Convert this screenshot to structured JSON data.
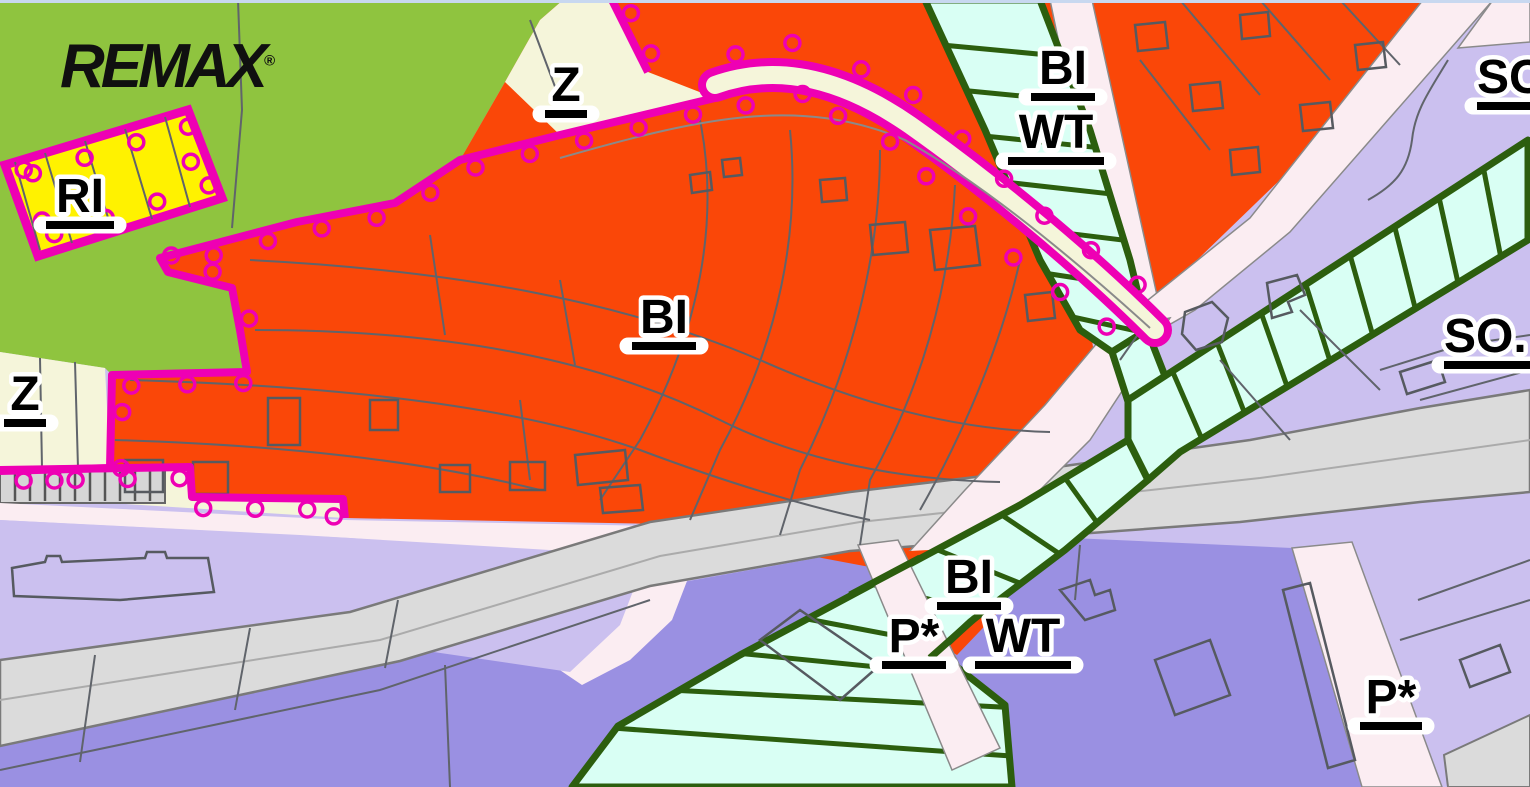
{
  "logo": {
    "text": "REMAX",
    "registered": "®"
  },
  "labels": {
    "z_top": "Z",
    "ri": "RI",
    "z_left": "Z",
    "bi_main": "BI",
    "bi_top": "BI",
    "wt_top": "WT",
    "so_top_right": "SO",
    "so_right": "SO.",
    "bi_south": "BI",
    "p_star_south": "P*",
    "wt_south": "WT",
    "p_star_southeast": "P*"
  },
  "colors": {
    "green_space": "#8FC43F",
    "zone_bi_orange": "#FA4708",
    "zone_ri_yellow": "#FFF200",
    "zone_z_cream": "#F5F5DA",
    "zone_so_lavender": "#CBC0EF",
    "zone_p_periwinkle": "#9A90E2",
    "road_pink": "#FBEDF2",
    "road_gray": "#DBDBDB",
    "road_edge": "#7A7A7A",
    "garage_gray": "#D6D6D6",
    "stream_fill": "#D9FFF4",
    "stream_border": "#2C5E0E",
    "boundary_magenta": "#EE00B4",
    "parcel_line": "#60646B",
    "building_line": "#565A60",
    "top_strip_blue": "#C8D8F0",
    "logo_black": "#101010"
  }
}
